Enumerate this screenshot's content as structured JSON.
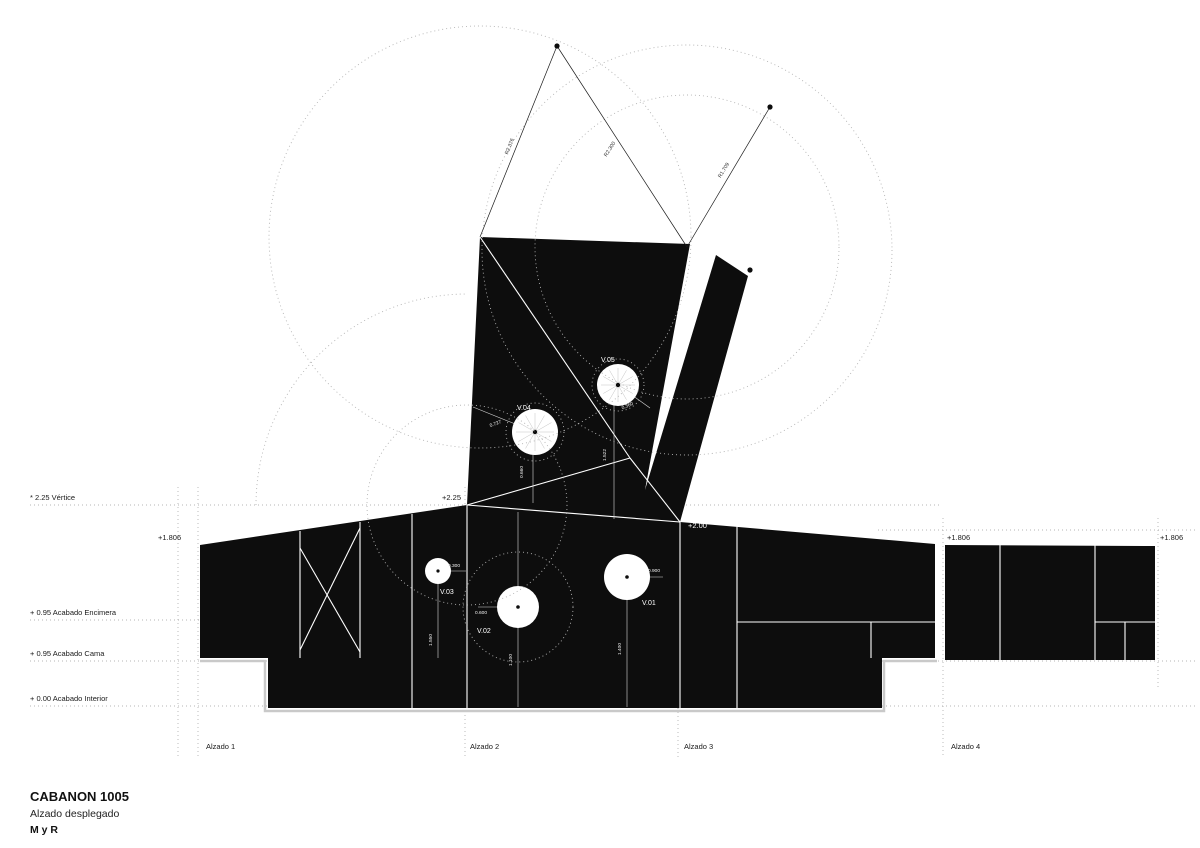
{
  "title_block": {
    "project": "CABANON 1005",
    "drawing_name": "Alzado desplegado",
    "author": "M y R"
  },
  "level_labels": {
    "vertice": "* 2.25 Vértice",
    "l1806_left": "+1.806",
    "l1806_mid": "+1.806",
    "l1806_right": "+1.806",
    "encimera": "+ 0.95 Acabado Encimera",
    "cama": "+ 0.95 Acabado Cama",
    "interior": "+ 0.00 Acabado Interior"
  },
  "marks": {
    "apex": "+2.25",
    "ridge": "+2.00"
  },
  "elevations": [
    {
      "label": "Alzado 1"
    },
    {
      "label": "Alzado 2"
    },
    {
      "label": "Alzado 3"
    },
    {
      "label": "Alzado 4"
    }
  ],
  "windows": [
    {
      "id": "V.01",
      "diameter_dim": "0.900",
      "height_dim": "1.400"
    },
    {
      "id": "V.02",
      "diameter_dim": "0.600",
      "height_dim": "1.100"
    },
    {
      "id": "V.03",
      "diameter_dim": "0.300",
      "height_dim": "1.550"
    },
    {
      "id": "V.04",
      "dim_a": "0.727",
      "dim_b": "0.660"
    },
    {
      "id": "V.05",
      "dim_a": "0.360",
      "dim_b": "1.522"
    }
  ],
  "radii": [
    {
      "label": "R2.376"
    },
    {
      "label": "R2.300"
    },
    {
      "label": "R1.709"
    }
  ],
  "colors": {
    "ink": "#0d0d0d",
    "background": "#ffffff",
    "construction": "#b4b4b4",
    "slab_outline": "#c9c9c9"
  }
}
